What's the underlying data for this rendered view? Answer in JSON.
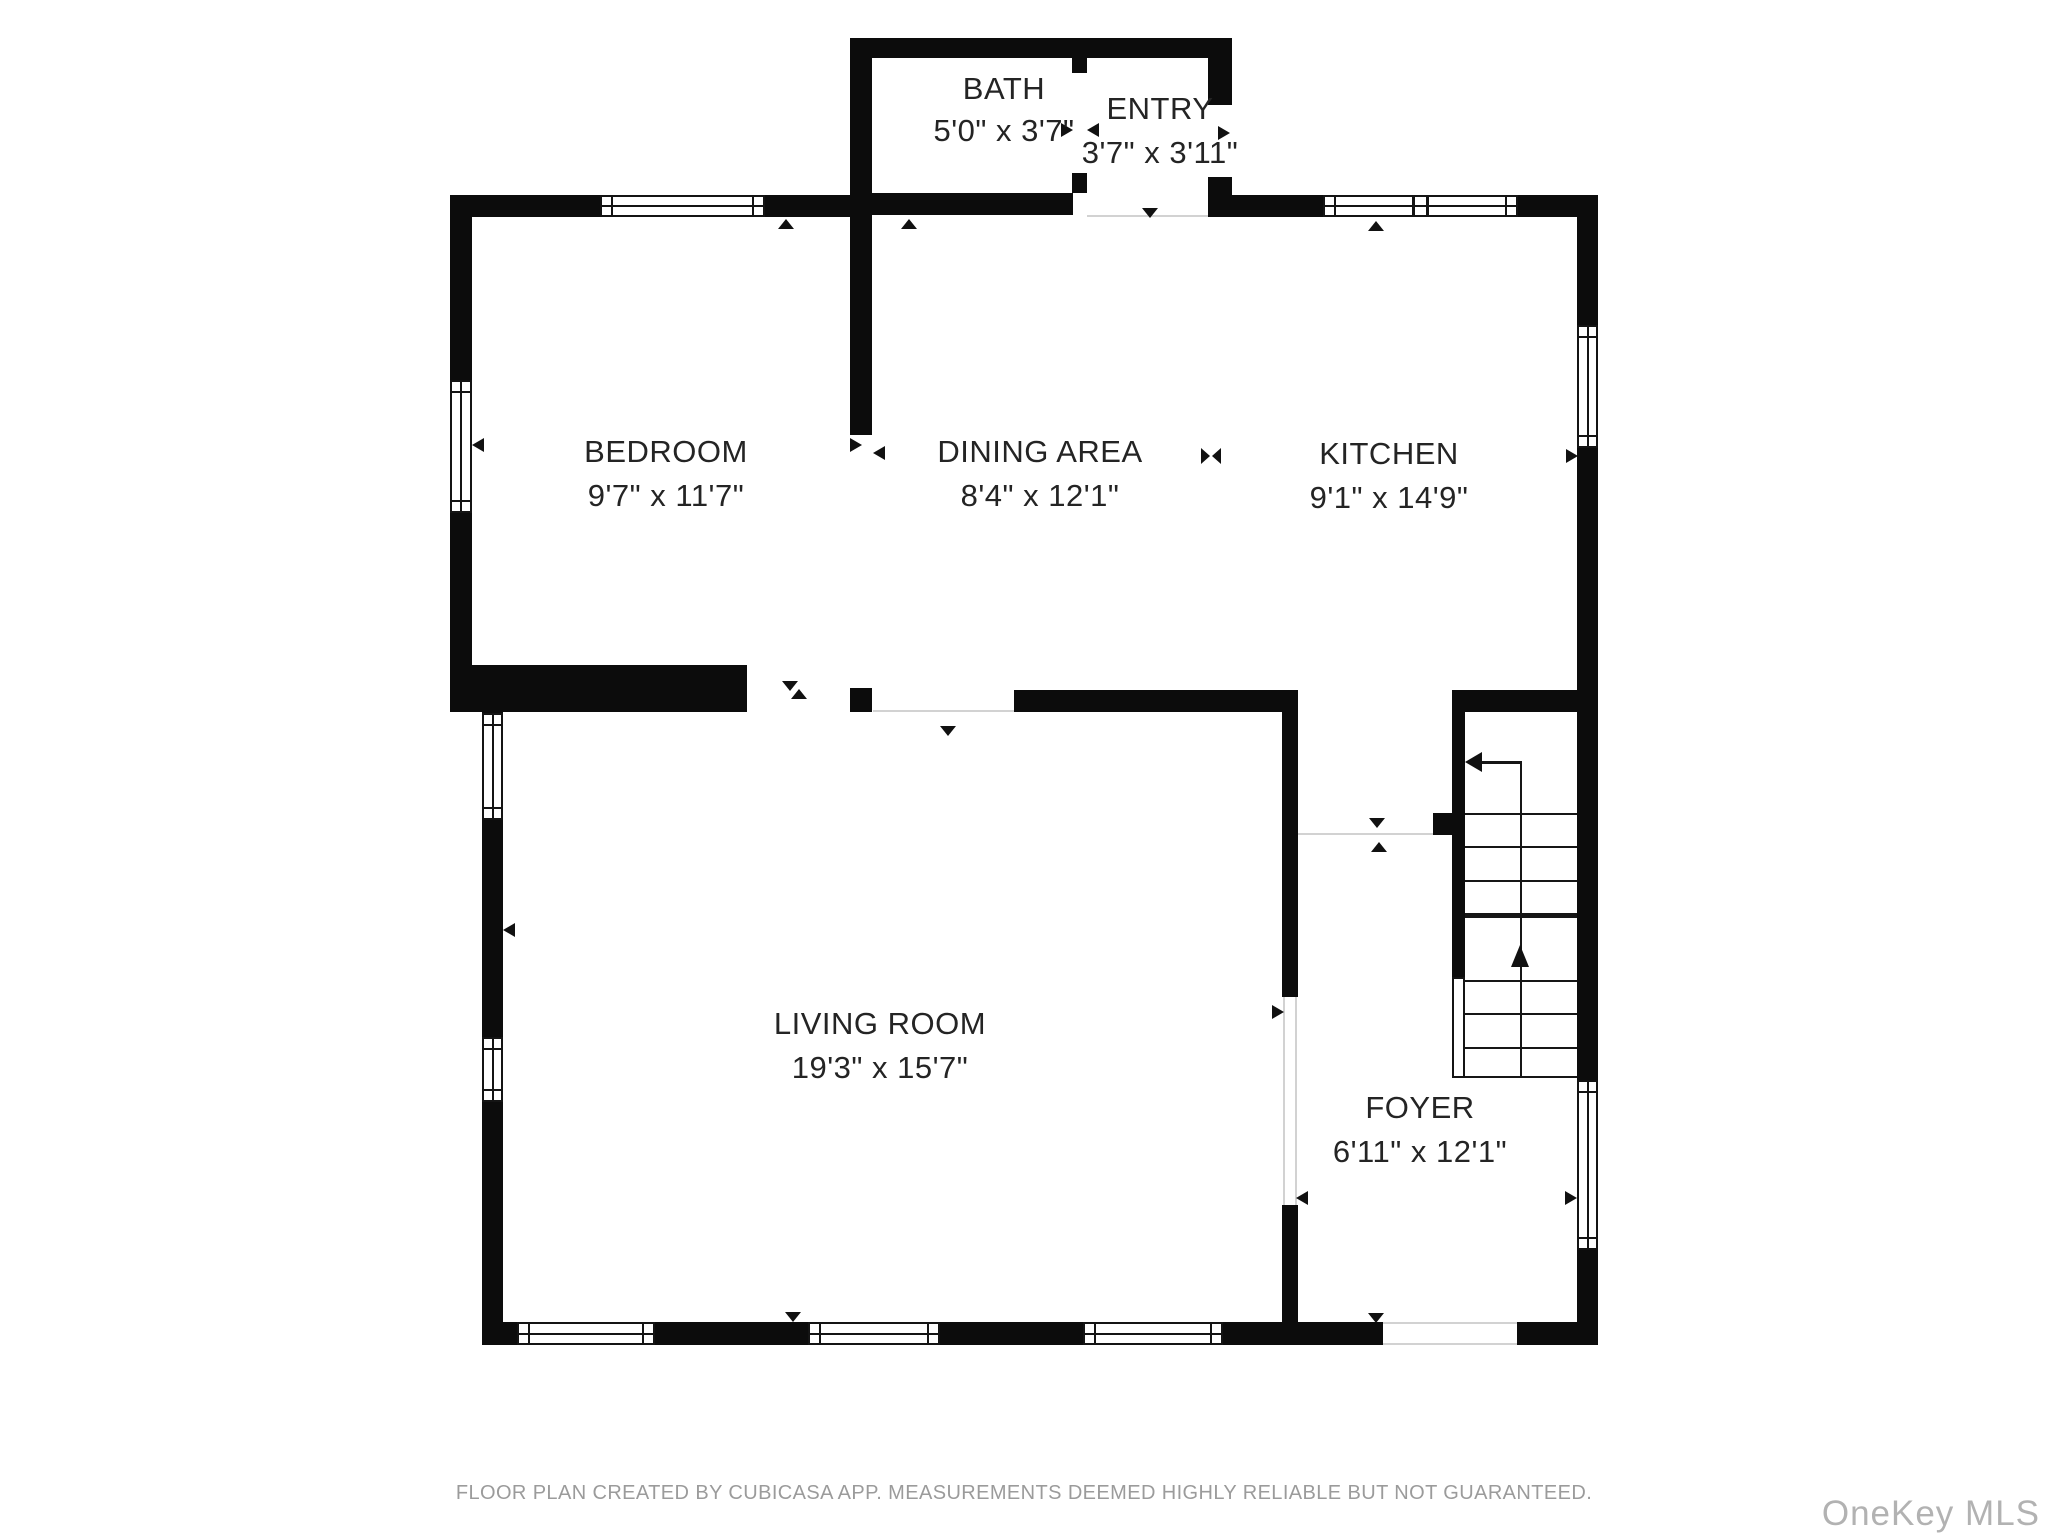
{
  "rooms": [
    {
      "name": "BATH",
      "dims": "5'0\" x 3'7\""
    },
    {
      "name": "ENTRY",
      "dims": "3'7\" x 3'11\""
    },
    {
      "name": "BEDROOM",
      "dims": "9'7\" x 11'7\""
    },
    {
      "name": "DINING AREA",
      "dims": "8'4\" x 12'1\""
    },
    {
      "name": "KITCHEN",
      "dims": "9'1\" x 14'9\""
    },
    {
      "name": "LIVING ROOM",
      "dims": "19'3\" x 15'7\""
    },
    {
      "name": "FOYER",
      "dims": "6'11\" x 12'1\""
    }
  ],
  "footer": {
    "disclaimer": "FLOOR PLAN CREATED BY CUBICASA APP. MEASUREMENTS DEEMED HIGHLY RELIABLE BUT NOT GUARANTEED."
  },
  "watermark": {
    "text": "OneKey MLS"
  },
  "colors": {
    "wall": "#0c0c0c",
    "label": "#242424",
    "footer": "#9b9b9b",
    "watermark": "#b2b2b2"
  }
}
